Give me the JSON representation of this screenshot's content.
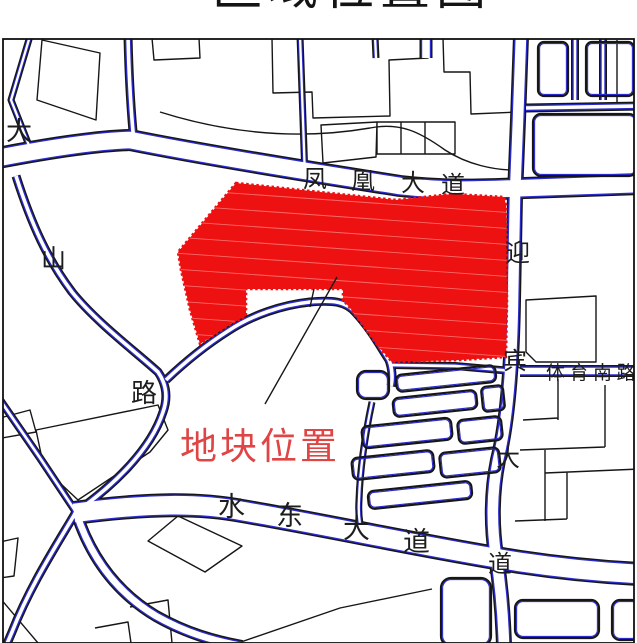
{
  "title": {
    "text": "区域位置图"
  },
  "map": {
    "plot": {
      "label": "地块位置"
    },
    "roads": {
      "fenghuang": {
        "name": "凤凰大道",
        "chars": [
          "凤",
          "凰",
          "大",
          "道"
        ]
      },
      "yingbin": {
        "name": "迎宾大道",
        "chars": [
          "迎",
          "宾",
          "大",
          "道"
        ]
      },
      "tiyunan": {
        "name": "体育南路"
      },
      "shuidong": {
        "name": "水东大道",
        "chars": [
          "水",
          "东",
          "大",
          "道"
        ]
      },
      "west": {
        "name": "大山路",
        "chars": [
          "大",
          "山",
          "路"
        ]
      }
    },
    "colors": {
      "road_line_blue": "#2b2bcc",
      "drawing_black": "#161616",
      "plot_fill_red": "#ee1111",
      "plot_label_red": "#e04545",
      "frame_black": "#111111",
      "background": "#ffffff"
    }
  }
}
